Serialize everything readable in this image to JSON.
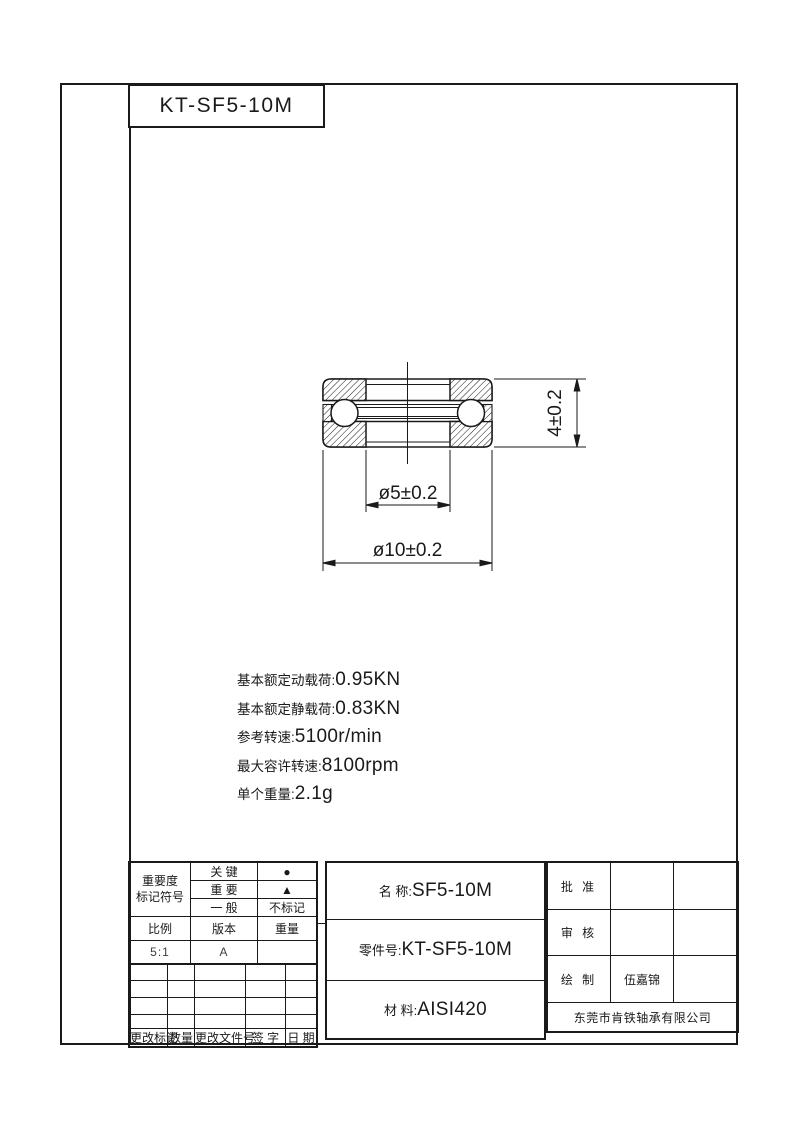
{
  "sheet": {
    "bg": "#ffffff",
    "ink": "#1a1a1a"
  },
  "top_box": {
    "label": "KT-SF5-10M"
  },
  "drawing": {
    "dim_height": "4±0.2",
    "dim_bore": "ø5±0.2",
    "dim_outer": "ø10±0.2"
  },
  "specs": [
    {
      "label": "基本额定动载荷:",
      "value": "0.95KN"
    },
    {
      "label": "基本额定静载荷:",
      "value": "0.83KN"
    },
    {
      "label": "参考转速:",
      "value": "5100r/min"
    },
    {
      "label": "最大容许转速:",
      "value": "8100rpm"
    },
    {
      "label": "单个重量:",
      "value": "2.1g"
    }
  ],
  "rev_table": {
    "importance_line1": "重要度",
    "importance_line2": "标记符号",
    "levels": [
      {
        "name": "关 键",
        "mark": "●"
      },
      {
        "name": "重 要",
        "mark": "▲"
      },
      {
        "name": "一 般",
        "mark": "不标记"
      }
    ],
    "scale_label": "比例",
    "version_label": "版本",
    "weight_label": "重量",
    "scale_value": "5:1",
    "version_value": "A",
    "weight_value": "",
    "footer": [
      "更改标记",
      "数量",
      "更改文件号",
      "签 字",
      "日 期"
    ]
  },
  "part_info": {
    "name_label": "名  称:",
    "name_value": "SF5-10M",
    "part_no_label": "零件号:",
    "part_no_value": "KT-SF5-10M",
    "material_label": "材  料:",
    "material_value": "AISI420"
  },
  "approval": {
    "approve_label": "批 准",
    "approve_name": "",
    "check_label": "审 核",
    "check_name": "",
    "draw_label": "绘 制",
    "draw_name": "伍嘉锦",
    "company": "东莞市肯铁轴承有限公司"
  }
}
